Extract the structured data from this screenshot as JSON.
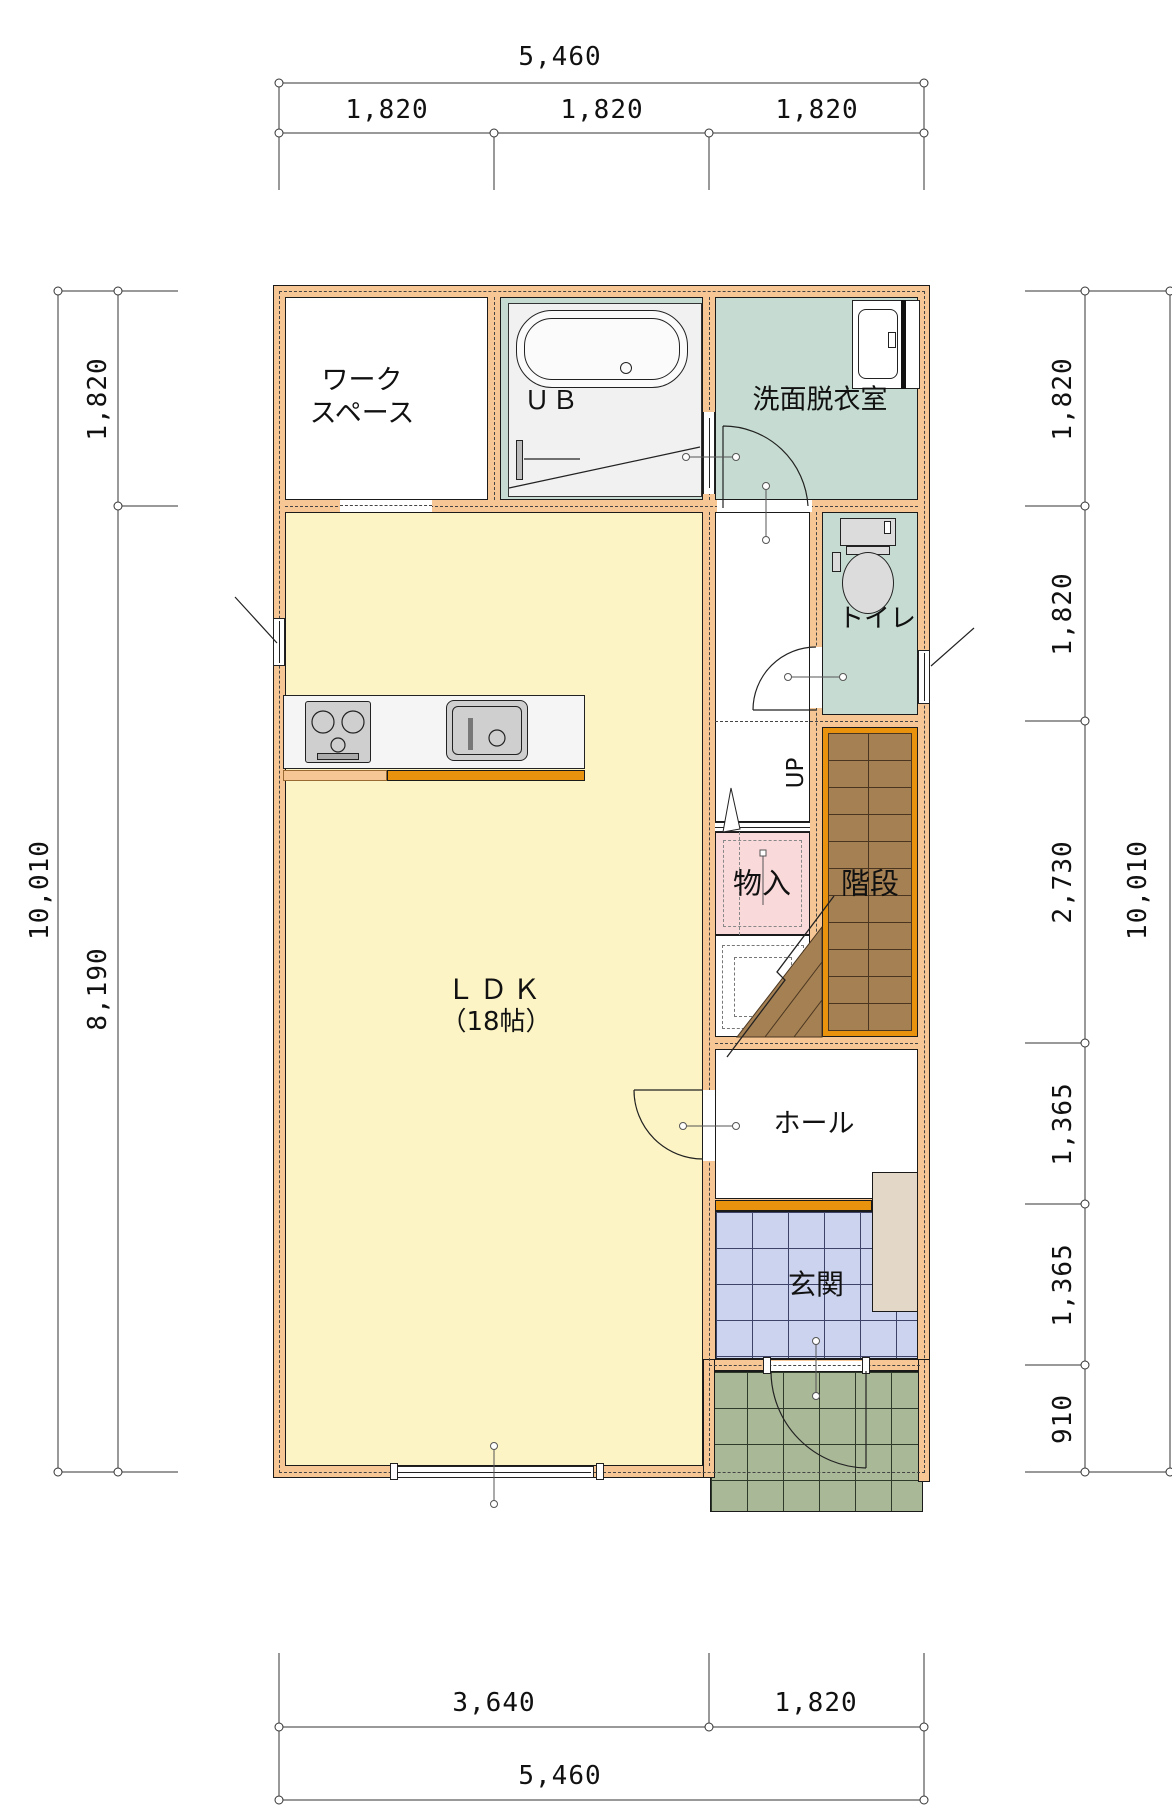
{
  "plan": {
    "rooms": {
      "workspace": {
        "label_line1": "ワーク",
        "label_line2": "スペース"
      },
      "bath": {
        "label": "ＵＢ"
      },
      "washroom": {
        "label": "洗面脱衣室"
      },
      "toilet": {
        "label": "トイレ"
      },
      "ldk": {
        "label": "ＬＤＫ",
        "size": "（18帖）"
      },
      "storage": {
        "label": "物入"
      },
      "stairs": {
        "label": "階段",
        "up": "UP"
      },
      "hall": {
        "label": "ホール"
      },
      "entrance": {
        "label": "玄関"
      }
    },
    "dimensions": {
      "top": {
        "total": "5,460",
        "segments": [
          "1,820",
          "1,820",
          "1,820"
        ]
      },
      "bottom": {
        "segments": [
          "3,640",
          "1,820"
        ],
        "total": "5,460"
      },
      "left": {
        "segments": [
          "1,820",
          "8,190"
        ],
        "total": "10,010"
      },
      "right": {
        "segments": [
          "1,820",
          "1,820",
          "2,730",
          "1,365",
          "1,365",
          "910"
        ],
        "total": "10,010"
      }
    },
    "colors": {
      "wall": "#F6C795",
      "ldk_floor": "#FCF4C4",
      "wet_room_floor": "#C6DCD2",
      "storage_floor": "#F9D9DA",
      "stair_floor": "#A58053",
      "stair_frame": "#E8920E",
      "genkan_tile": "#CCD3EE",
      "porch_tile": "#A9B897",
      "cabinet": "#E3D8C8",
      "counter_front": "#E8920E"
    }
  }
}
